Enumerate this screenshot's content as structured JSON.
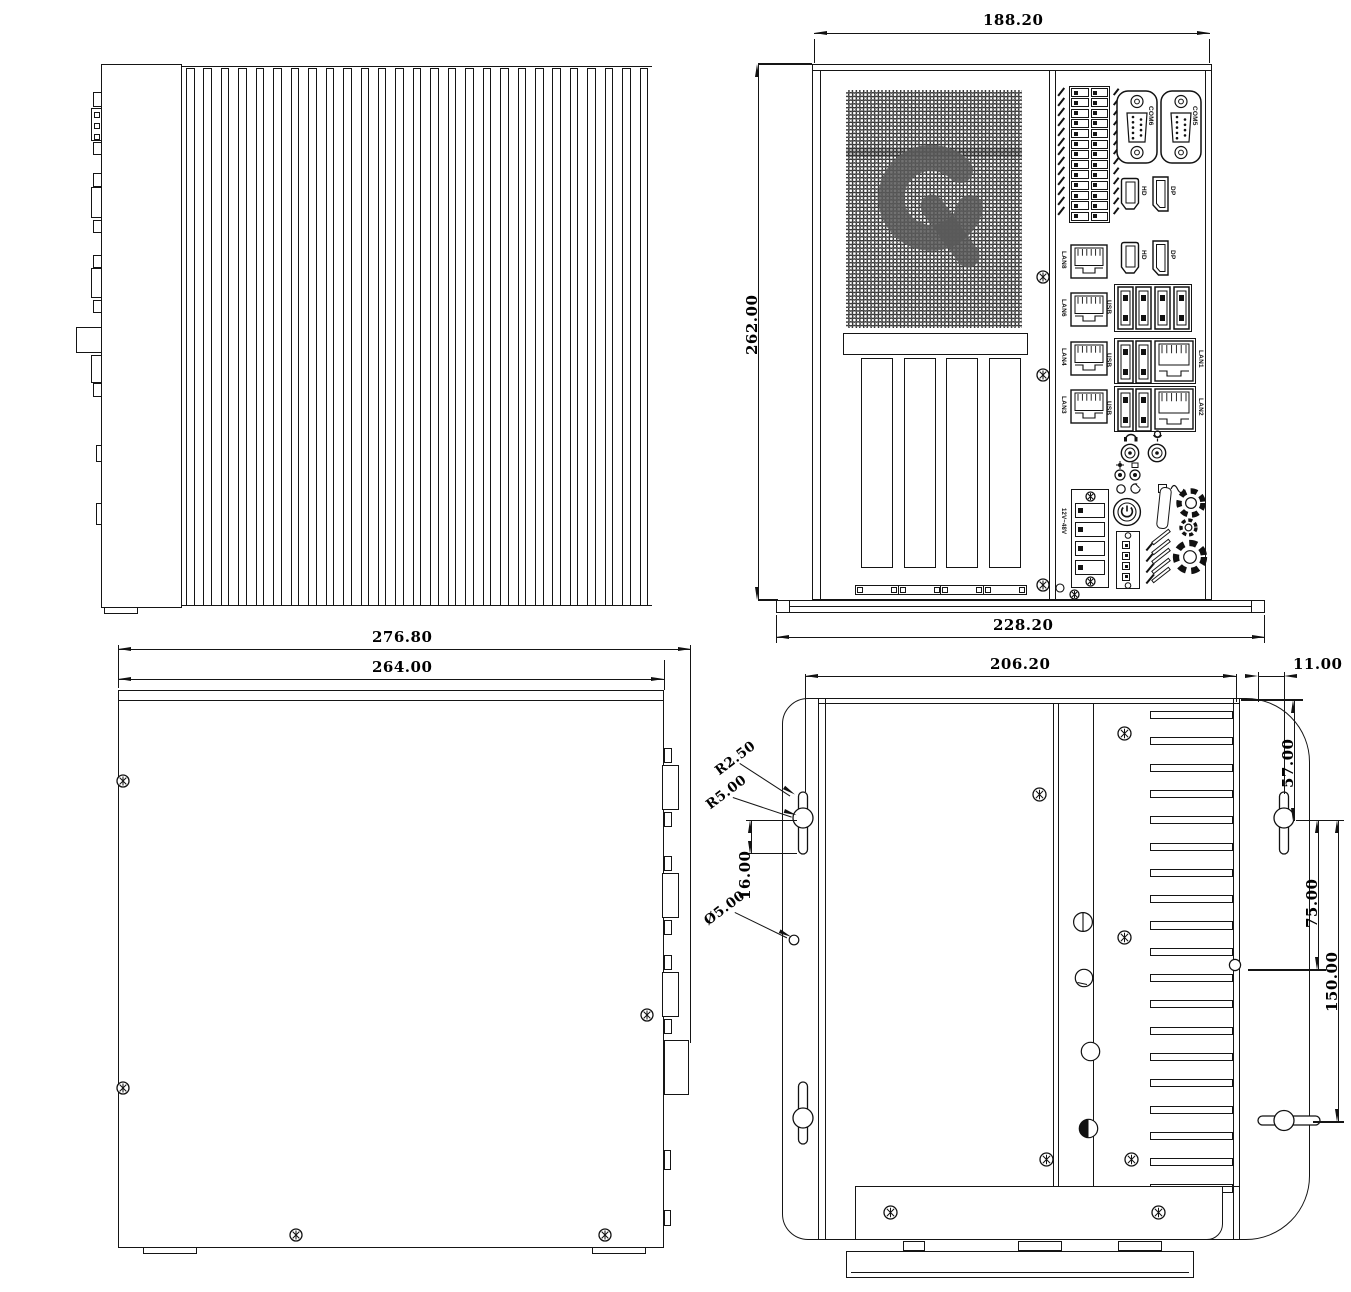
{
  "front_view": {
    "dim_width_top": "188.20",
    "dim_height_left": "262.00",
    "dim_width_bottom": "228.20",
    "ports": {
      "com_left": "COM6",
      "com_right": "COM5",
      "hdmi_1": "HD",
      "dp_1": "DP",
      "hdmi_2": "HD",
      "dp_2": "DP",
      "lan_col": [
        "LAN8",
        "LAN6",
        "LAN4",
        "LAN3"
      ],
      "usb_quad": "USB",
      "usb_combo_1": "USB",
      "lan_combo_1": "LAN1",
      "usb_combo_2": "USB",
      "lan_combo_2": "LAN2",
      "power_label": "12V~48V"
    }
  },
  "bottom_view": {
    "dim_width_outer": "276.80",
    "dim_width_inner": "264.00"
  },
  "bracket_view": {
    "dim_width": "206.20",
    "dim_flange": "11.00",
    "dim_hole_top": "57.00",
    "dim_hole_mid": "75.00",
    "dim_hole_span": "150.00",
    "dim_slot": "16.00",
    "note_radius_slot": "R2.50",
    "note_radius_hole": "R5.00",
    "note_diameter": "Ø5.00"
  }
}
